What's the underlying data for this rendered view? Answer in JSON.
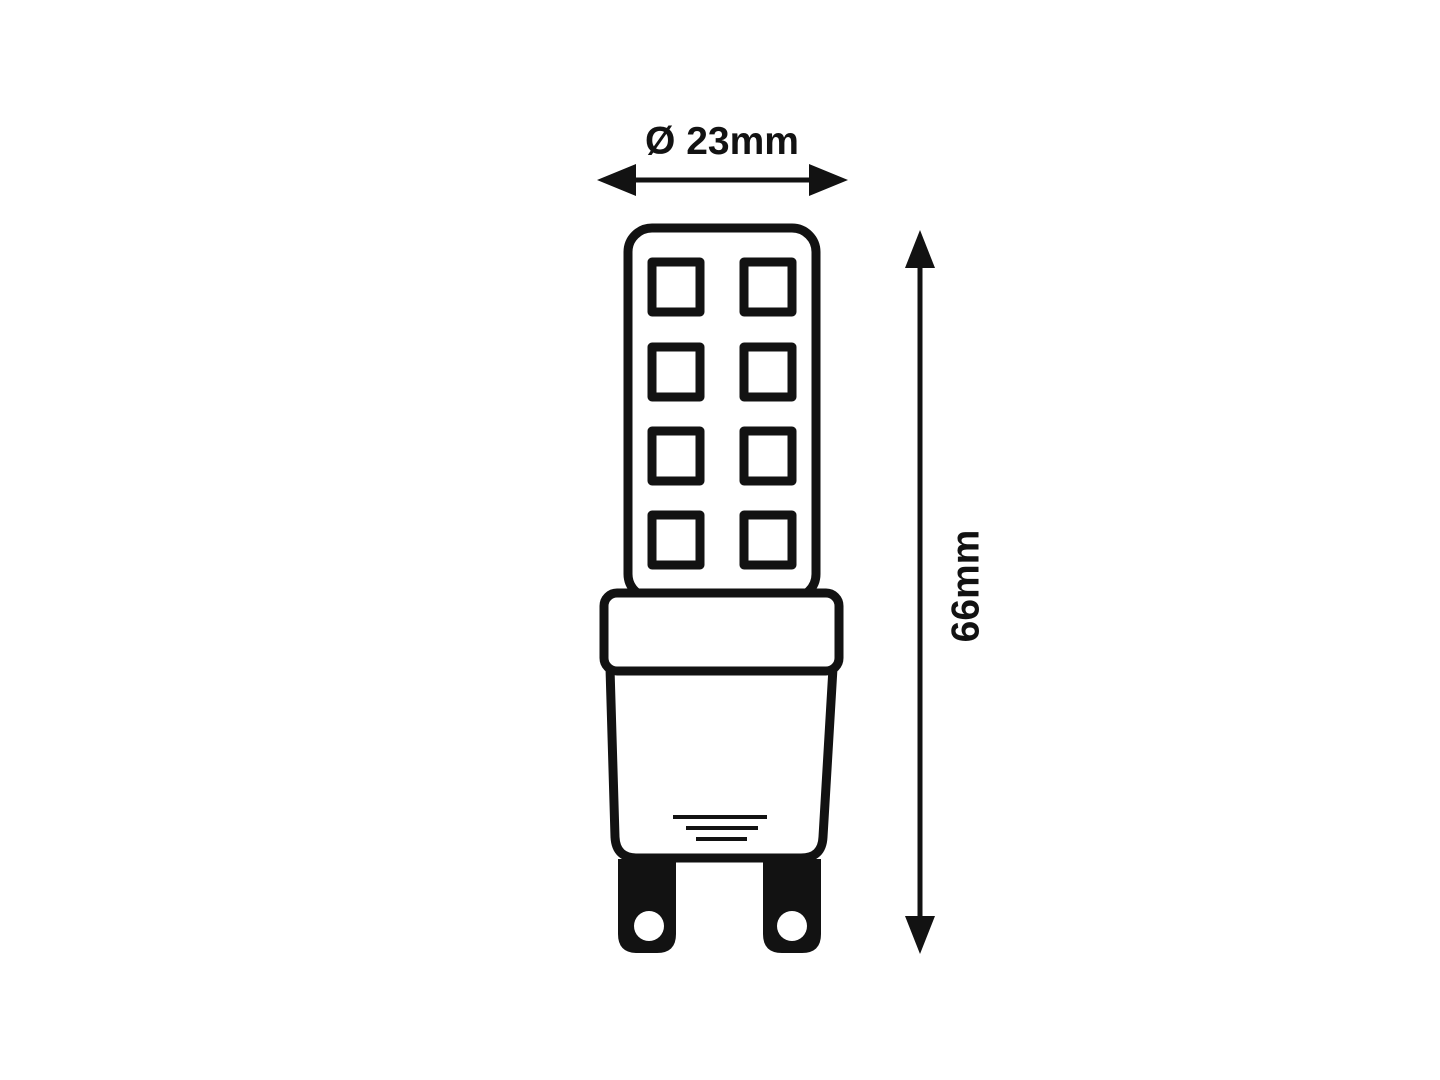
{
  "page": {
    "background_color": "#ffffff",
    "line_color": "#121212"
  },
  "diagram": {
    "kind": "technical-dimension-drawing",
    "labels": {
      "diameter": "Ø 23mm",
      "height": "66mm"
    },
    "led_grid": {
      "rows": 4,
      "columns": 2
    },
    "base_hatch_line_count": 3,
    "pin_count": 2
  }
}
